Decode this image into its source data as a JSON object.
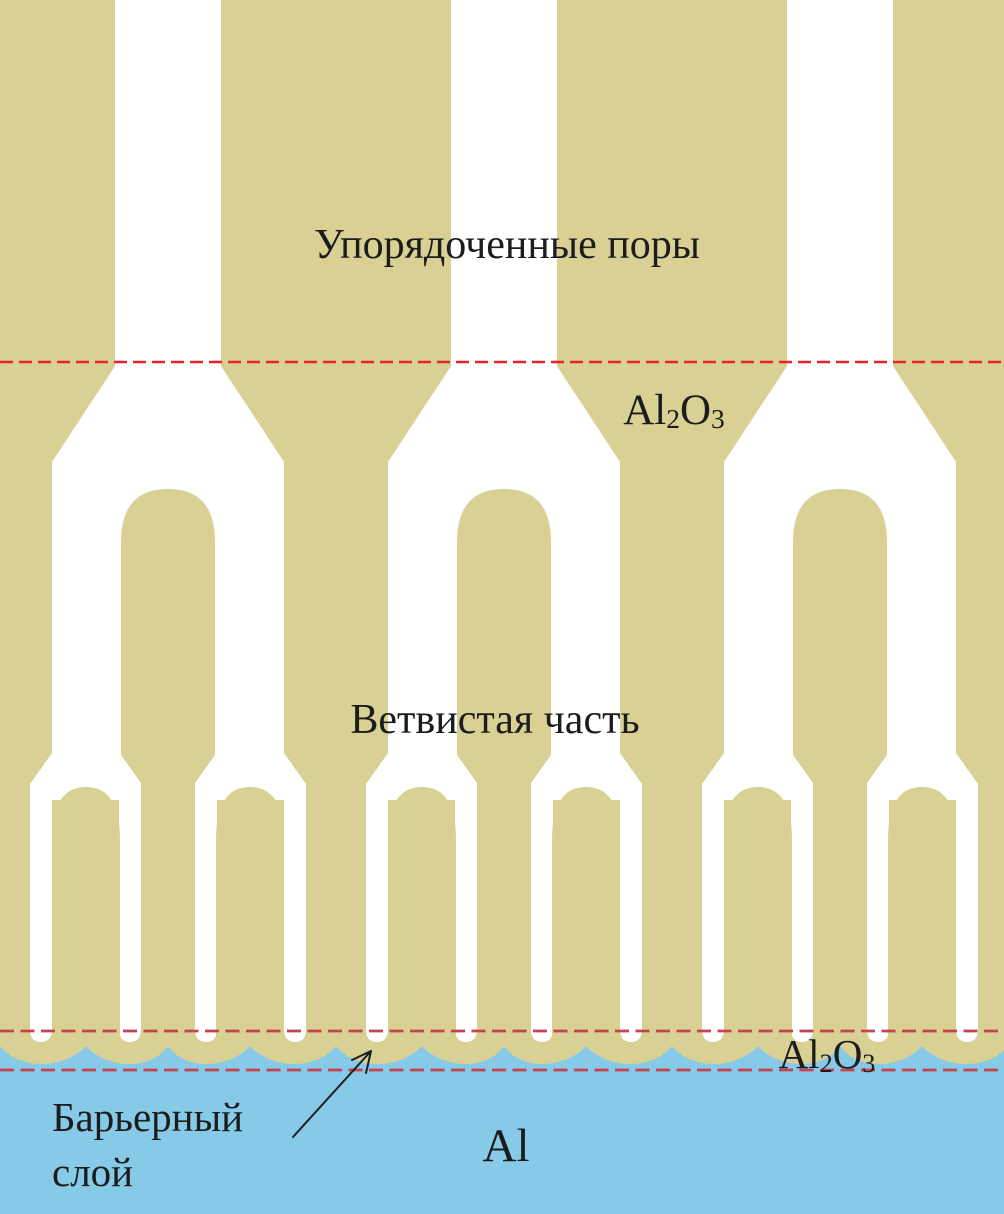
{
  "labels": {
    "ordered_pores": "Упорядоченные поры",
    "branched_part": "Ветвистая часть",
    "barrier_layer_line1": "Барьерный",
    "barrier_layer_line2": "слой",
    "aluminum": "Al"
  },
  "formula_al2o3": {
    "base1": "Al",
    "sub1": "2",
    "base2": "O",
    "sub2": "3"
  },
  "colors": {
    "alumina": "#d9d193",
    "pore": "#ffffff",
    "aluminum": "#87cae7",
    "boundary_top": "#e8222b",
    "boundary_bottom": "#c4434e",
    "text": "#1c1c1c"
  }
}
